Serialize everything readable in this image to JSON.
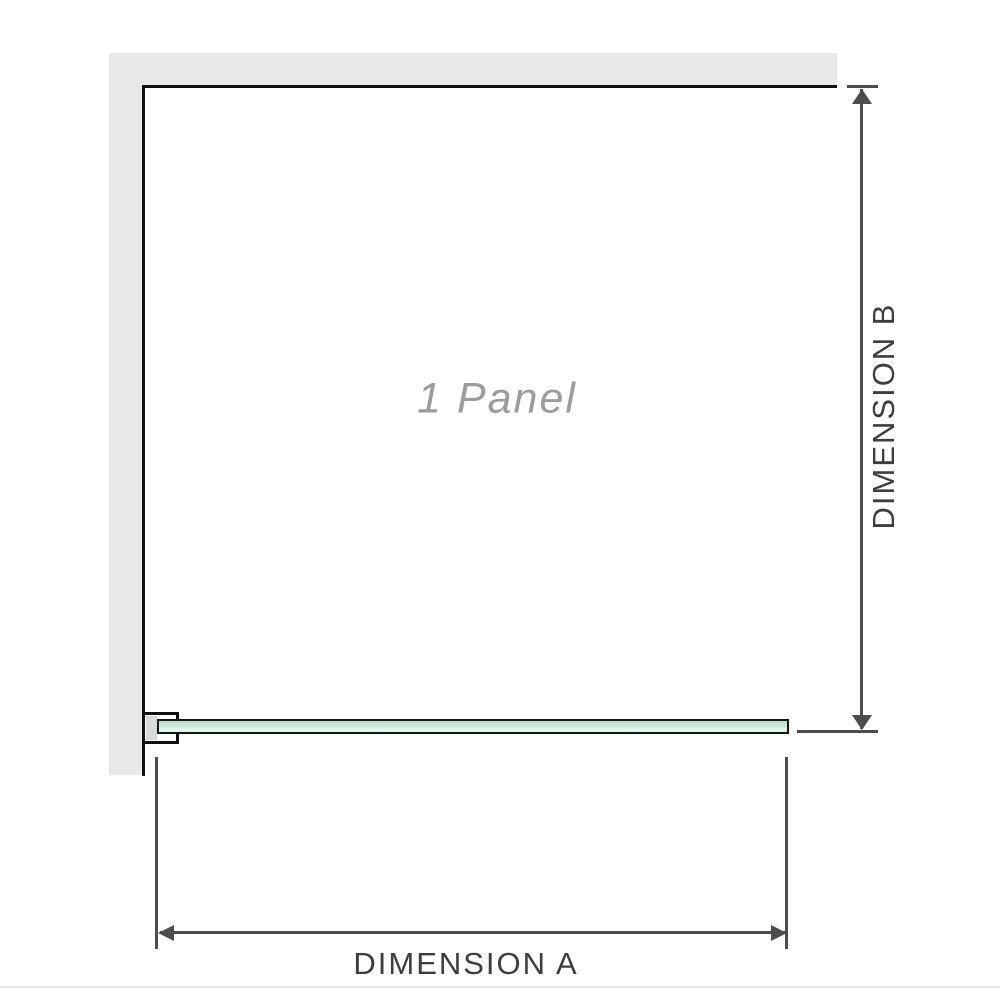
{
  "labels": {
    "panel": "1 Panel",
    "dimension_a": "DIMENSION A",
    "dimension_b": "DIMENSION B"
  },
  "colors": {
    "background": "#ffffff",
    "wall": "#e9e9e9",
    "outline": "#101010",
    "glass_border": "#161616",
    "glass_green_top": "#b5e1c9",
    "glass_green_bottom": "#ebf8f1",
    "bracket_fill": "#d9d9d9",
    "dimension_line": "#4d4d4d",
    "dimension_text": "#3e3e3e",
    "panel_text": "#9c9c9c",
    "divider": "#e3e3e3"
  }
}
